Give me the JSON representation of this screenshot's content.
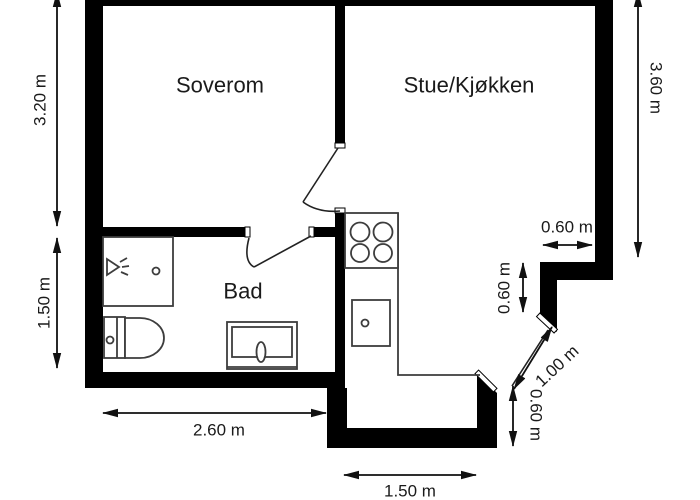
{
  "title": "Apartment floor plan",
  "colors": {
    "wall": "#000000",
    "fixture_line": "#3d3d3d",
    "dimension_line": "#111111",
    "background": "#ffffff",
    "text": "#1a1a1a"
  },
  "rooms": {
    "bedroom": "Soverom",
    "living_kitchen": "Stue/Kjøkken",
    "bathroom": "Bad"
  },
  "dimensions": {
    "bedroom_height": "3.20 m",
    "bathroom_height": "1.50 m",
    "living_kitchen_height": "3.60 m",
    "bathroom_width": "2.60 m",
    "hall_width": "1.50 m",
    "niche_width": "0.60 m",
    "niche_depth": "0.60 m",
    "entry_door_diagonal": "1.00 m",
    "hall_depth": "0.60 m"
  },
  "fixtures": {
    "stove": "stove-4-burners-icon",
    "kitchen_sink": "kitchen-sink-icon",
    "shower": "shower-cabin-icon",
    "toilet": "toilet-icon",
    "bathroom_sink": "bathroom-vanity-sink-icon"
  }
}
